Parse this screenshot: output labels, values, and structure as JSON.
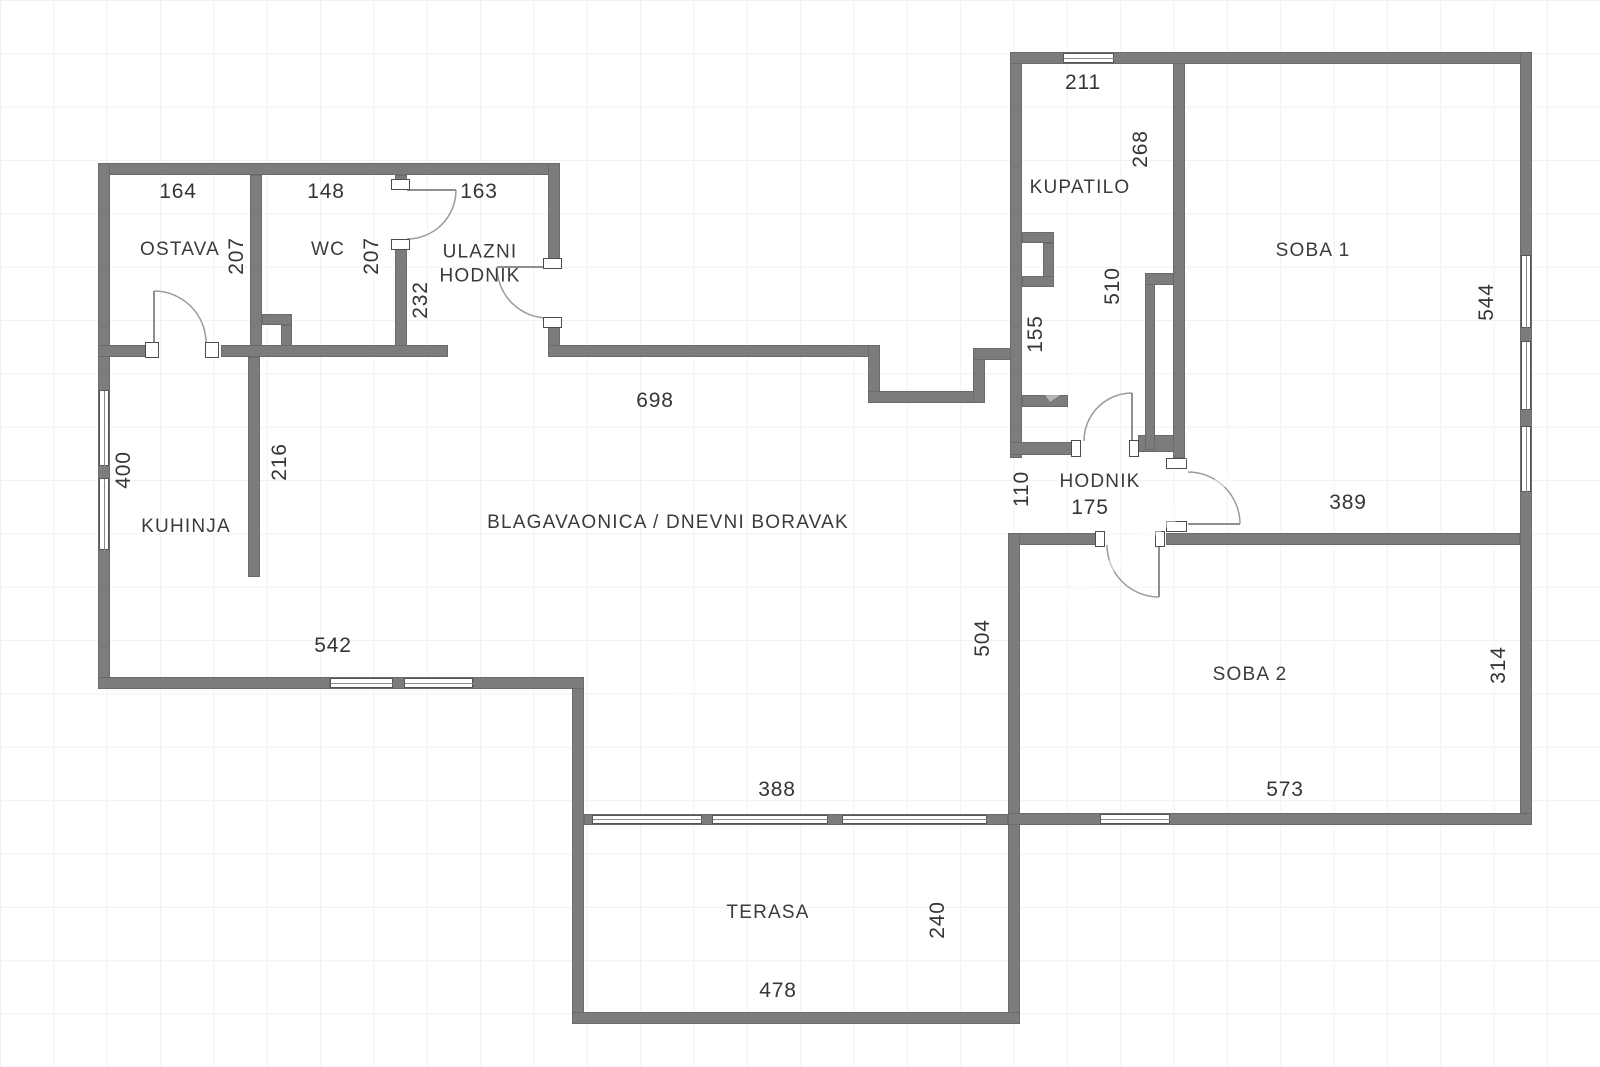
{
  "title": "floor-plan",
  "style": {
    "wall_color": "#7c7c7c",
    "wall_edge_color": "#6b6b6b",
    "text_color": "#3b3b3b",
    "grid_color": "#f1f1f1",
    "background": "#ffffff"
  },
  "rooms": [
    {
      "id": "ostava",
      "label": "OSTAVA",
      "x": 180,
      "y": 250
    },
    {
      "id": "wc",
      "label": "WC",
      "x": 328,
      "y": 250
    },
    {
      "id": "ulazni-hodnik",
      "label": "ULAZNI\nHODNIK",
      "x": 480,
      "y": 264
    },
    {
      "id": "kupatilo",
      "label": "KUPATILO",
      "x": 1080,
      "y": 188
    },
    {
      "id": "soba-1",
      "label": "SOBA 1",
      "x": 1313,
      "y": 251
    },
    {
      "id": "kuhinja",
      "label": "KUHINJA",
      "x": 186,
      "y": 527
    },
    {
      "id": "blagavaonica",
      "label": "BLAGAVAONICA / DNEVNI BORAVAK",
      "x": 668,
      "y": 523
    },
    {
      "id": "hodnik",
      "label": "HODNIK",
      "x": 1100,
      "y": 482
    },
    {
      "id": "soba-2",
      "label": "SOBA 2",
      "x": 1250,
      "y": 675
    },
    {
      "id": "terasa",
      "label": "TERASA",
      "x": 768,
      "y": 913
    }
  ],
  "dimensions": [
    {
      "text": "164",
      "x": 178,
      "y": 192,
      "rot": false
    },
    {
      "text": "148",
      "x": 326,
      "y": 192,
      "rot": false
    },
    {
      "text": "163",
      "x": 479,
      "y": 192,
      "rot": false
    },
    {
      "text": "211",
      "x": 1083,
      "y": 83,
      "rot": false
    },
    {
      "text": "207",
      "x": 237,
      "y": 256,
      "rot": true
    },
    {
      "text": "207",
      "x": 372,
      "y": 256,
      "rot": true
    },
    {
      "text": "232",
      "x": 421,
      "y": 300,
      "rot": true
    },
    {
      "text": "268",
      "x": 1141,
      "y": 149,
      "rot": true
    },
    {
      "text": "510",
      "x": 1113,
      "y": 286,
      "rot": true
    },
    {
      "text": "155",
      "x": 1036,
      "y": 334,
      "rot": true
    },
    {
      "text": "698",
      "x": 655,
      "y": 401,
      "rot": false
    },
    {
      "text": "400",
      "x": 124,
      "y": 470,
      "rot": true
    },
    {
      "text": "216",
      "x": 280,
      "y": 462,
      "rot": true
    },
    {
      "text": "544",
      "x": 1487,
      "y": 302,
      "rot": true
    },
    {
      "text": "110",
      "x": 1022,
      "y": 489,
      "rot": true
    },
    {
      "text": "175",
      "x": 1090,
      "y": 508,
      "rot": false
    },
    {
      "text": "389",
      "x": 1348,
      "y": 503,
      "rot": false
    },
    {
      "text": "504",
      "x": 983,
      "y": 638,
      "rot": true
    },
    {
      "text": "542",
      "x": 333,
      "y": 646,
      "rot": false
    },
    {
      "text": "314",
      "x": 1499,
      "y": 665,
      "rot": true
    },
    {
      "text": "573",
      "x": 1285,
      "y": 790,
      "rot": false
    },
    {
      "text": "388",
      "x": 777,
      "y": 790,
      "rot": false
    },
    {
      "text": "240",
      "x": 938,
      "y": 920,
      "rot": true
    },
    {
      "text": "478",
      "x": 778,
      "y": 991,
      "rot": false
    }
  ],
  "walls": [
    [
      98,
      163,
      462,
      12
    ],
    [
      98,
      163,
      12,
      526
    ],
    [
      250,
      175,
      12,
      182
    ],
    [
      395,
      175,
      12,
      9
    ],
    [
      395,
      248,
      12,
      109
    ],
    [
      548,
      163,
      12,
      98
    ],
    [
      548,
      326,
      12,
      31
    ],
    [
      98,
      345,
      50,
      12
    ],
    [
      221,
      345,
      227,
      12
    ],
    [
      262,
      314,
      30,
      11
    ],
    [
      281,
      325,
      11,
      21
    ],
    [
      548,
      345,
      332,
      12
    ],
    [
      868,
      345,
      12,
      58
    ],
    [
      868,
      391,
      117,
      12
    ],
    [
      973,
      348,
      12,
      55
    ],
    [
      973,
      348,
      49,
      12
    ],
    [
      1010,
      52,
      12,
      406
    ],
    [
      1022,
      232,
      32,
      11
    ],
    [
      1043,
      243,
      11,
      44
    ],
    [
      1022,
      276,
      32,
      11
    ],
    [
      1022,
      395,
      46,
      12
    ],
    [
      1010,
      442,
      65,
      13
    ],
    [
      1138,
      435,
      47,
      17
    ],
    [
      1145,
      273,
      10,
      177
    ],
    [
      1145,
      273,
      40,
      12
    ],
    [
      1173,
      52,
      12,
      406
    ],
    [
      1010,
      52,
      522,
      12
    ],
    [
      1520,
      52,
      12,
      773
    ],
    [
      1008,
      533,
      90,
      12
    ],
    [
      1166,
      533,
      354,
      12
    ],
    [
      1008,
      533,
      12,
      491
    ],
    [
      1008,
      813,
      524,
      12
    ],
    [
      572,
      677,
      12,
      347
    ],
    [
      584,
      814,
      424,
      11
    ],
    [
      572,
      1012,
      448,
      12
    ],
    [
      98,
      677,
      232,
      12
    ],
    [
      330,
      677,
      143,
      12
    ],
    [
      473,
      677,
      111,
      12
    ],
    [
      248,
      357,
      12,
      220
    ]
  ],
  "windows": [
    {
      "x": 99,
      "y": 390,
      "w": 10,
      "h": 76,
      "o": "v"
    },
    {
      "x": 99,
      "y": 478,
      "w": 10,
      "h": 72,
      "o": "v"
    },
    {
      "x": 330,
      "y": 678,
      "w": 63,
      "h": 10,
      "o": "h"
    },
    {
      "x": 404,
      "y": 678,
      "w": 69,
      "h": 10,
      "o": "h"
    },
    {
      "x": 1063,
      "y": 53,
      "w": 51,
      "h": 10,
      "o": "h"
    },
    {
      "x": 1521,
      "y": 255,
      "w": 10,
      "h": 73,
      "o": "v"
    },
    {
      "x": 1521,
      "y": 341,
      "w": 10,
      "h": 69,
      "o": "v"
    },
    {
      "x": 1521,
      "y": 426,
      "w": 10,
      "h": 66,
      "o": "v"
    },
    {
      "x": 592,
      "y": 815,
      "w": 110,
      "h": 9,
      "o": "h"
    },
    {
      "x": 712,
      "y": 815,
      "w": 116,
      "h": 9,
      "o": "h"
    },
    {
      "x": 842,
      "y": 815,
      "w": 145,
      "h": 9,
      "o": "h"
    },
    {
      "x": 1100,
      "y": 814,
      "w": 70,
      "h": 10,
      "o": "h"
    }
  ],
  "door_jambs": [
    [
      145,
      342,
      14,
      16
    ],
    [
      205,
      342,
      14,
      16
    ],
    [
      391,
      179,
      19,
      11
    ],
    [
      391,
      239,
      19,
      11
    ],
    [
      543,
      258,
      19,
      11
    ],
    [
      543,
      317,
      19,
      11
    ],
    [
      1071,
      440,
      10,
      17
    ],
    [
      1129,
      440,
      10,
      17
    ],
    [
      1166,
      458,
      21,
      11
    ],
    [
      1166,
      521,
      21,
      11
    ],
    [
      1095,
      531,
      10,
      16
    ],
    [
      1155,
      531,
      10,
      16
    ]
  ],
  "doors": [
    {
      "name": "ostava-door",
      "leaf": [
        154,
        343,
        154,
        291
      ],
      "arc": "M 154 291 A 52 52 0 0 1 206 343"
    },
    {
      "name": "wc-door",
      "leaf": [
        407,
        190,
        456,
        190
      ],
      "arc": "M 456 190 A 49 49 0 0 1 407 239"
    },
    {
      "name": "entrance-door",
      "leaf": [
        548,
        267,
        497,
        267
      ],
      "arc": "M 497 267 A 51 51 0 0 0 548 318"
    },
    {
      "name": "kupatilo-door",
      "leaf": [
        1132,
        441,
        1132,
        393
      ],
      "arc": "M 1132 393 A 48 48 0 0 0 1084 441"
    },
    {
      "name": "soba1-door",
      "leaf": [
        1188,
        524,
        1240,
        524
      ],
      "arc": "M 1188 472 A 52 52 0 0 1 1240 524"
    },
    {
      "name": "soba2-door",
      "leaf": [
        1159,
        545,
        1159,
        597
      ],
      "arc": "M 1107 545 A 52 52 0 0 0 1159 597"
    }
  ],
  "watermark_stripes": [
    {
      "x": 1015,
      "y": 575,
      "w": 150,
      "h": 12,
      "r": -35
    },
    {
      "x": 1120,
      "y": 505,
      "w": 120,
      "h": 12,
      "r": -35
    },
    {
      "x": 1180,
      "y": 430,
      "w": 95,
      "h": 11,
      "r": -35
    },
    {
      "x": 1040,
      "y": 370,
      "w": 80,
      "h": 10,
      "r": -35
    },
    {
      "x": 660,
      "y": 672,
      "w": 90,
      "h": 10,
      "r": -35
    }
  ]
}
